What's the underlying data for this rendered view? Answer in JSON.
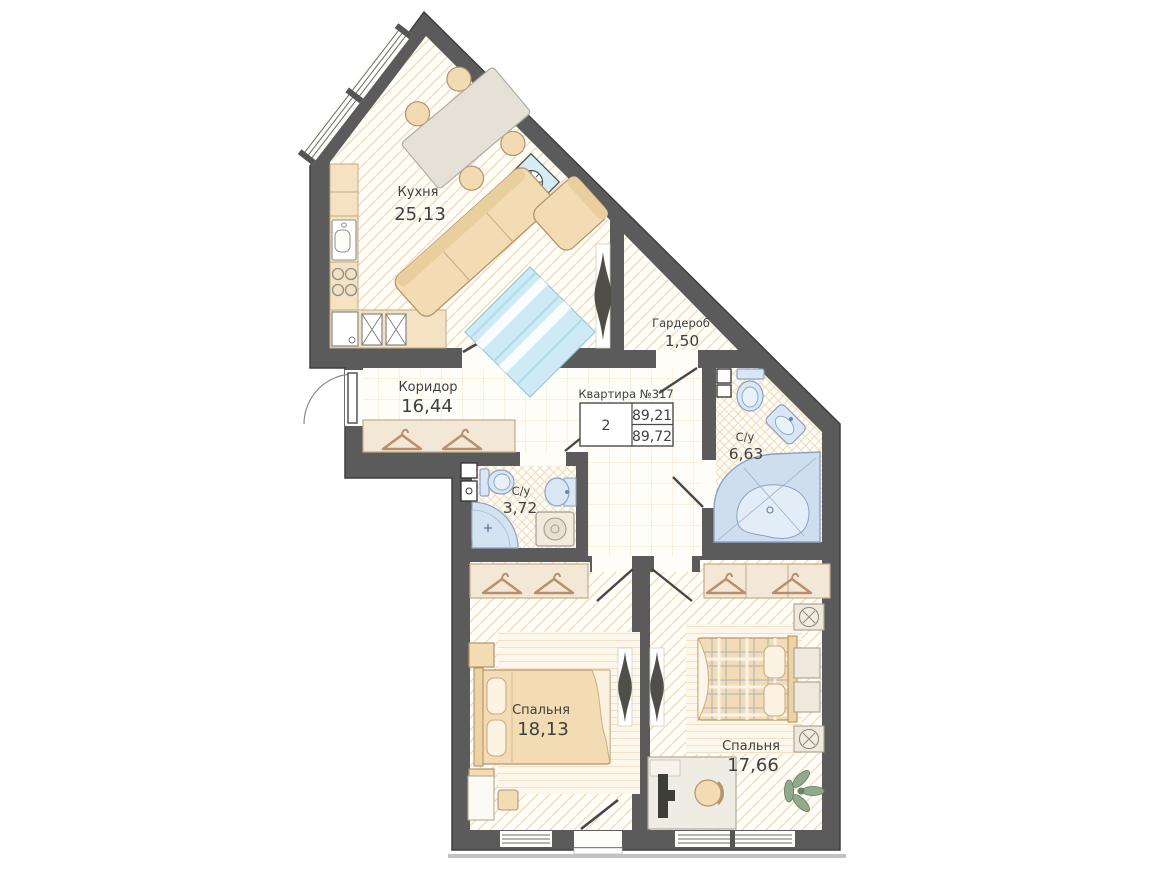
{
  "plan": {
    "apartment": {
      "title": "Квартира №317",
      "rooms_count": "2",
      "area_top": "89,21",
      "area_bottom": "89,72"
    },
    "rooms": [
      {
        "id": "kitchen",
        "name": "Кухня",
        "area": "25,13"
      },
      {
        "id": "wardrobe-room",
        "name": "Гардероб",
        "area": "1,50"
      },
      {
        "id": "corridor",
        "name": "Коридор",
        "area": "16,44"
      },
      {
        "id": "bathroom-large",
        "name": "С/у",
        "area": "6,63"
      },
      {
        "id": "bathroom-small",
        "name": "С/у",
        "area": "3,72"
      },
      {
        "id": "bedroom-1",
        "name": "Спальня",
        "area": "18,13"
      },
      {
        "id": "bedroom-2",
        "name": "Спальня",
        "area": "17,66"
      }
    ],
    "colors": {
      "wall": "#5b5b5b",
      "floor_base": "#fffdf8",
      "floor_hatch": "#f2dcbe",
      "floor_grid": "#f5e7cf",
      "furniture_beige": "#f3dcb4",
      "furniture_stroke": "#b5936b",
      "wardrobe_fill": "#f3e8d5",
      "fixture_blue": "#d9e6f3",
      "fixture_stroke": "#8ba3c2",
      "accent_blue": "#cdeaf5",
      "tv_dark": "#504f47",
      "text": "#3f3f3f"
    }
  }
}
